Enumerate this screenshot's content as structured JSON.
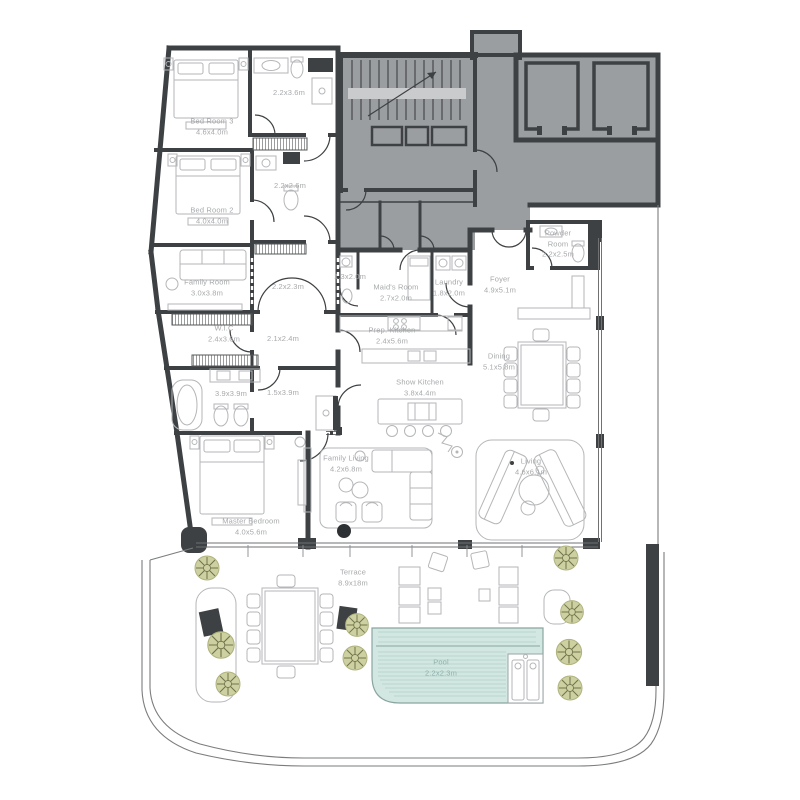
{
  "plan": {
    "type": "residential-floor-plan",
    "rooms": [
      {
        "id": "bed-room-3",
        "name": "Bed Room 3",
        "dims": "4.6x4.0m"
      },
      {
        "id": "bath-3",
        "name": "",
        "dims": "2.2x3.6m"
      },
      {
        "id": "bath-2",
        "name": "",
        "dims": "2.2x2.6m"
      },
      {
        "id": "bed-room-2",
        "name": "Bed Room 2",
        "dims": "4.0x4.0m"
      },
      {
        "id": "family-room",
        "name": "Family Room",
        "dims": "3.0x3.8m"
      },
      {
        "id": "closet",
        "name": "",
        "dims": "2.2x2.3m"
      },
      {
        "id": "maid-bath",
        "name": "",
        "dims": "1.3x2.0m"
      },
      {
        "id": "maids-room",
        "name": "Maid's Room",
        "dims": "2.7x2.0m"
      },
      {
        "id": "laundry",
        "name": "Laundry",
        "dims": "1.8x2.0m"
      },
      {
        "id": "foyer",
        "name": "Foyer",
        "dims": "4.9x5.1m"
      },
      {
        "id": "powder-room",
        "name": "Powder Room",
        "dims": "2.2x2.5m"
      },
      {
        "id": "wic",
        "name": "W.I.C",
        "dims": "2.4x3.6m"
      },
      {
        "id": "hall-21",
        "name": "",
        "dims": "2.1x2.4m"
      },
      {
        "id": "prep-kitchen",
        "name": "Prep. Kitchen",
        "dims": "2.4x5.6m"
      },
      {
        "id": "dining",
        "name": "Dining",
        "dims": "5.1x5.8m"
      },
      {
        "id": "master-bath",
        "name": "",
        "dims": "3.9x3.9m"
      },
      {
        "id": "hall-15",
        "name": "",
        "dims": "1.5x3.9m"
      },
      {
        "id": "show-kitchen",
        "name": "Show Kitchen",
        "dims": "3.8x4.4m"
      },
      {
        "id": "family-living",
        "name": "Family Living",
        "dims": "4.2x6.8m"
      },
      {
        "id": "living",
        "name": "Living",
        "dims": "4.6x6.1m"
      },
      {
        "id": "master-bedroom",
        "name": "Master Bedroom",
        "dims": "4.0x5.6m"
      },
      {
        "id": "terrace",
        "name": "Terrace",
        "dims": "8.9x18m"
      },
      {
        "id": "pool",
        "name": "Pool",
        "dims": "2.2x2.3m"
      }
    ],
    "colors": {
      "wall": "#3e4143",
      "core_fill": "#9b9ea1",
      "furniture_line": "#b4b6b8",
      "label": "#a7a9ab",
      "pool_fill": "#d3e7e2",
      "pool_edge": "#8aa5a0",
      "tree_fill": "#cdd0a0",
      "tree_line": "#70734a"
    }
  }
}
